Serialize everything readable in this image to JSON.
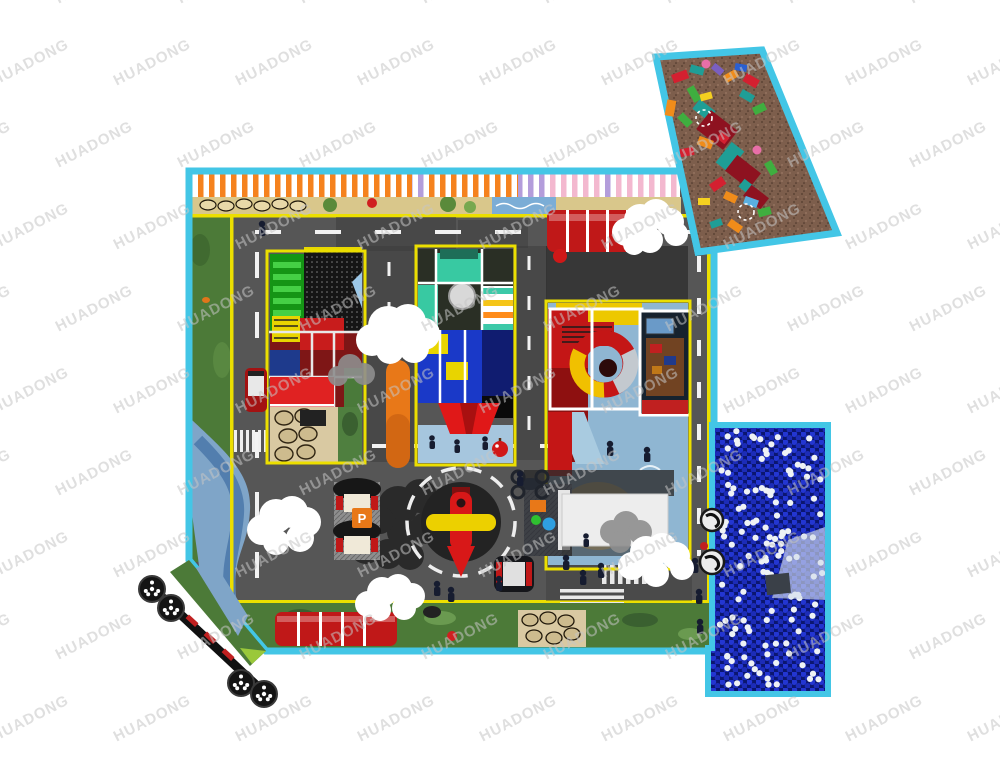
{
  "watermark": {
    "text": "HUADONG",
    "color": "#c6c6c6"
  },
  "palette": {
    "border_cyan": "#43c6e6",
    "line_yellow": "#ecdf00",
    "road_gray": "#565656",
    "road_shadow": "#3a3a3a",
    "grass_green": "#4c7a38",
    "grass_dark": "#3f6630",
    "mural_sand": "#d9c78b",
    "river_blue": "#7fa5c8",
    "carpet_brown": "#7d5e4c",
    "ballpit_blue": "#0b1670",
    "ball_white": "#eef2f5",
    "awning_orange": "#f5821e",
    "awning_purple": "#b39ddb",
    "awning_pink": "#f3b8cf",
    "structure_red": "#c41616",
    "structure_dark_red": "#8e1010",
    "structure_blue": "#1a39c8",
    "structure_teal": "#38c9a2",
    "structure_green": "#159515",
    "slide_red": "#e01818",
    "rocket_red": "#d81818",
    "rocket_yellow": "#ecd000",
    "tunnel_red": "#c01818",
    "orange_accent": "#e87818",
    "stone_tan": "#d9c9a2",
    "floor_lightblue": "#a6c6de",
    "wave_floor_blue": "#8fb6d2",
    "cloud_white": "#ffffff",
    "cloud_gray": "#8e8e8e",
    "cloud_dark": "#262626",
    "canopy_white": "#ededed",
    "figure_navy": "#161c30"
  },
  "signs": {
    "table_sign": "P"
  },
  "zones": {
    "block_area": "foam-blocks-corner",
    "main_area": "traffic-town-playground",
    "ball_pit": "blue-ball-pit",
    "left_structure": "green-climber-trampoline-house",
    "center_structure": "softplay-tower-roller-slide",
    "right_structure": "red-tower-spiral-tube-slide",
    "roundabout": "roundabout-rocket-ride",
    "cafe": "seating-tables",
    "kiosk": "service-kiosk-canopy",
    "train": "corner-track-train"
  }
}
